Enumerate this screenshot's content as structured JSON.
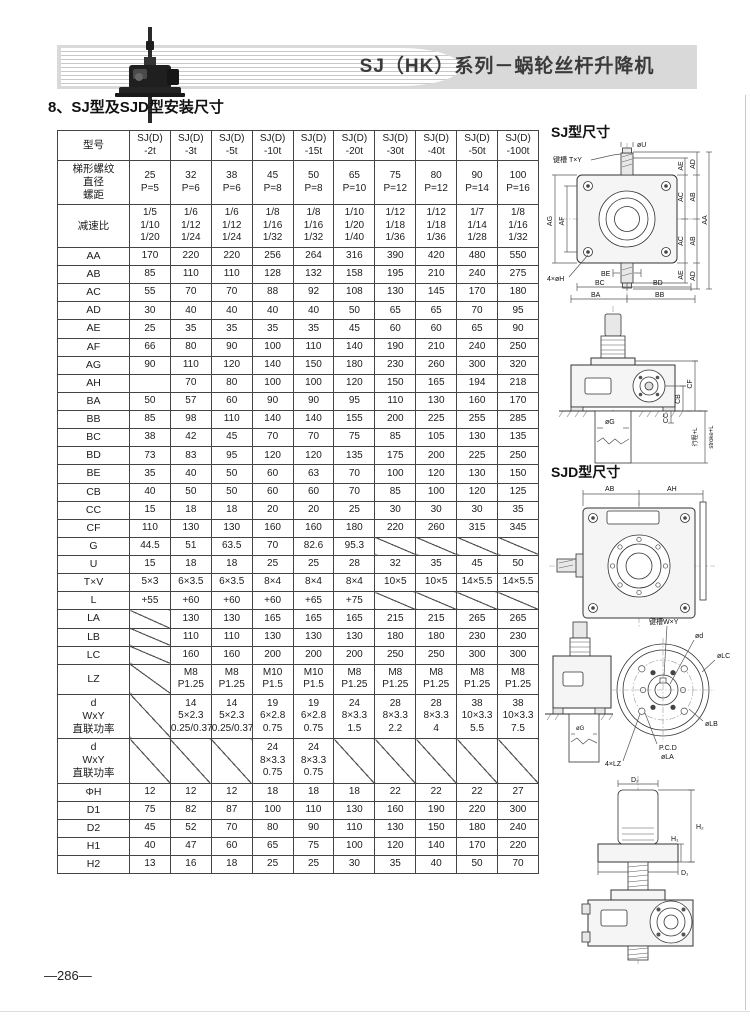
{
  "page": {
    "header_title": "SJ（HK）系列－蜗轮丝杆升降机",
    "section_title": "8、SJ型及SJD型安装尺寸",
    "page_number": "—286—"
  },
  "table": {
    "header": {
      "label": "型号",
      "models": [
        [
          "SJ(D)",
          "-2t"
        ],
        [
          "SJ(D)",
          "-3t"
        ],
        [
          "SJ(D)",
          "-5t"
        ],
        [
          "SJ(D)",
          "-10t"
        ],
        [
          "SJ(D)",
          "-15t"
        ],
        [
          "SJ(D)",
          "-20t"
        ],
        [
          "SJ(D)",
          "-30t"
        ],
        [
          "SJ(D)",
          "-40t"
        ],
        [
          "SJ(D)",
          "-50t"
        ],
        [
          "SJ(D)",
          "-100t"
        ]
      ]
    },
    "rows": [
      {
        "label": [
          "梯形螺纹",
          "直径",
          "螺距"
        ],
        "values": [
          [
            "25",
            "P=5"
          ],
          [
            "32",
            "P=6"
          ],
          [
            "38",
            "P=6"
          ],
          [
            "45",
            "P=8"
          ],
          [
            "50",
            "P=8"
          ],
          [
            "65",
            "P=10"
          ],
          [
            "75",
            "P=12"
          ],
          [
            "80",
            "P=12"
          ],
          [
            "90",
            "P=14"
          ],
          [
            "100",
            "P=16"
          ]
        ]
      },
      {
        "label": "减速比",
        "values": [
          [
            "1/5",
            "1/10",
            "1/20"
          ],
          [
            "1/6",
            "1/12",
            "1/24"
          ],
          [
            "1/6",
            "1/12",
            "1/24"
          ],
          [
            "1/8",
            "1/16",
            "1/32"
          ],
          [
            "1/8",
            "1/16",
            "1/32"
          ],
          [
            "1/10",
            "1/20",
            "1/40"
          ],
          [
            "1/12",
            "1/18",
            "1/36"
          ],
          [
            "1/12",
            "1/18",
            "1/36"
          ],
          [
            "1/7",
            "1/14",
            "1/28"
          ],
          [
            "1/8",
            "1/16",
            "1/32"
          ]
        ]
      },
      {
        "label": "AA",
        "values": [
          "170",
          "220",
          "220",
          "256",
          "264",
          "316",
          "390",
          "420",
          "480",
          "550"
        ]
      },
      {
        "label": "AB",
        "values": [
          "85",
          "110",
          "110",
          "128",
          "132",
          "158",
          "195",
          "210",
          "240",
          "275"
        ]
      },
      {
        "label": "AC",
        "values": [
          "55",
          "70",
          "70",
          "88",
          "92",
          "108",
          "130",
          "145",
          "170",
          "180"
        ]
      },
      {
        "label": "AD",
        "values": [
          "30",
          "40",
          "40",
          "40",
          "40",
          "50",
          "65",
          "65",
          "70",
          "95"
        ]
      },
      {
        "label": "AE",
        "values": [
          "25",
          "35",
          "35",
          "35",
          "35",
          "45",
          "60",
          "60",
          "65",
          "90"
        ]
      },
      {
        "label": "AF",
        "values": [
          "66",
          "80",
          "90",
          "100",
          "110",
          "140",
          "190",
          "210",
          "240",
          "250"
        ]
      },
      {
        "label": "AG",
        "values": [
          "90",
          "110",
          "120",
          "140",
          "150",
          "180",
          "230",
          "260",
          "300",
          "320"
        ]
      },
      {
        "label": "AH",
        "values": [
          "",
          "70",
          "80",
          "100",
          "100",
          "120",
          "150",
          "165",
          "194",
          "218"
        ]
      },
      {
        "label": "BA",
        "values": [
          "50",
          "57",
          "60",
          "90",
          "90",
          "95",
          "110",
          "130",
          "160",
          "170"
        ]
      },
      {
        "label": "BB",
        "values": [
          "85",
          "98",
          "110",
          "140",
          "140",
          "155",
          "200",
          "225",
          "255",
          "285"
        ]
      },
      {
        "label": "BC",
        "values": [
          "38",
          "42",
          "45",
          "70",
          "70",
          "75",
          "85",
          "105",
          "130",
          "135"
        ]
      },
      {
        "label": "BD",
        "values": [
          "73",
          "83",
          "95",
          "120",
          "120",
          "135",
          "175",
          "200",
          "225",
          "250"
        ]
      },
      {
        "label": "BE",
        "values": [
          "35",
          "40",
          "50",
          "60",
          "63",
          "70",
          "100",
          "120",
          "130",
          "150"
        ]
      },
      {
        "label": "CB",
        "values": [
          "40",
          "50",
          "50",
          "60",
          "60",
          "70",
          "85",
          "100",
          "120",
          "125"
        ]
      },
      {
        "label": "CC",
        "values": [
          "15",
          "18",
          "18",
          "20",
          "20",
          "25",
          "30",
          "30",
          "30",
          "35"
        ]
      },
      {
        "label": "CF",
        "values": [
          "110",
          "130",
          "130",
          "160",
          "160",
          "180",
          "220",
          "260",
          "315",
          "345"
        ]
      },
      {
        "label": "G",
        "values": [
          "44.5",
          "51",
          "63.5",
          "70",
          "82.6",
          "95.3",
          "/",
          "/",
          "/",
          "/"
        ]
      },
      {
        "label": "U",
        "values": [
          "15",
          "18",
          "18",
          "25",
          "25",
          "28",
          "32",
          "35",
          "45",
          "50"
        ]
      },
      {
        "label": "T×V",
        "values": [
          "5×3",
          "6×3.5",
          "6×3.5",
          "8×4",
          "8×4",
          "8×4",
          "10×5",
          "10×5",
          "14×5.5",
          "14×5.5"
        ]
      },
      {
        "label": "L",
        "values": [
          "+55",
          "+60",
          "+60",
          "+60",
          "+65",
          "+75",
          "/",
          "/",
          "/",
          "/"
        ]
      },
      {
        "label": "LA",
        "values": [
          "/",
          "130",
          "130",
          "165",
          "165",
          "165",
          "215",
          "215",
          "265",
          "265"
        ]
      },
      {
        "label": "LB",
        "values": [
          "/",
          "110",
          "110",
          "130",
          "130",
          "130",
          "180",
          "180",
          "230",
          "230"
        ]
      },
      {
        "label": "LC",
        "values": [
          "/",
          "160",
          "160",
          "200",
          "200",
          "200",
          "250",
          "250",
          "300",
          "300"
        ]
      },
      {
        "label": "LZ",
        "values": [
          "/",
          [
            "M8",
            "P1.25"
          ],
          [
            "M8",
            "P1.25"
          ],
          [
            "M10",
            "P1.5"
          ],
          [
            "M10",
            "P1.5"
          ],
          [
            "M8",
            "P1.25"
          ],
          [
            "M8",
            "P1.25"
          ],
          [
            "M8",
            "P1.25"
          ],
          [
            "M8",
            "P1.25"
          ],
          [
            "M8",
            "P1.25"
          ]
        ]
      },
      {
        "label": [
          "d",
          "WxY",
          "直联功率"
        ],
        "values": [
          "/",
          [
            "14",
            "5×2.3",
            "0.25/0.37"
          ],
          [
            "14",
            "5×2.3",
            "0.25/0.37"
          ],
          [
            "19",
            "6×2.8",
            "0.75"
          ],
          [
            "19",
            "6×2.8",
            "0.75"
          ],
          [
            "24",
            "8×3.3",
            "1.5"
          ],
          [
            "28",
            "8×3.3",
            "2.2"
          ],
          [
            "28",
            "8×3.3",
            "4"
          ],
          [
            "38",
            "10×3.3",
            "5.5"
          ],
          [
            "38",
            "10×3.3",
            "7.5"
          ]
        ]
      },
      {
        "label": [
          "d",
          "WxY",
          "直联功率"
        ],
        "values": [
          "/",
          "/",
          "/",
          [
            "24",
            "8×3.3",
            "0.75"
          ],
          [
            "24",
            "8×3.3",
            "0.75"
          ],
          "/",
          "/",
          "/",
          "/",
          "/"
        ]
      },
      {
        "label": "ΦH",
        "values": [
          "12",
          "12",
          "12",
          "18",
          "18",
          "18",
          "22",
          "22",
          "22",
          "27"
        ]
      },
      {
        "label": "D1",
        "values": [
          "75",
          "82",
          "87",
          "100",
          "110",
          "130",
          "160",
          "190",
          "220",
          "300"
        ]
      },
      {
        "label": "D2",
        "values": [
          "45",
          "52",
          "70",
          "80",
          "90",
          "110",
          "130",
          "150",
          "180",
          "240"
        ]
      },
      {
        "label": "H1",
        "values": [
          "40",
          "47",
          "60",
          "65",
          "75",
          "100",
          "120",
          "140",
          "170",
          "220"
        ]
      },
      {
        "label": "H2",
        "values": [
          "13",
          "16",
          "18",
          "25",
          "25",
          "30",
          "35",
          "40",
          "50",
          "70"
        ]
      }
    ]
  },
  "drawings": {
    "sj_section_label": "SJ型尺寸",
    "sjd_section_label": "SJD型尺寸",
    "sj_top": {
      "phi_u": "øU",
      "keyway": "键槽 T×Y",
      "ae": "AE",
      "ad": "AD",
      "ac": "AC",
      "ab": "AB",
      "aa": "AA",
      "ag": "AG",
      "af": "AF",
      "holes": "4×øH",
      "be": "BE",
      "bc": "BC",
      "bd": "BD",
      "ba": "BA",
      "bb": "BB"
    },
    "sj_side": {
      "cf": "CF",
      "cb": "CB",
      "cc": "CC",
      "phi_g": "øG",
      "stroke_cn": "行程+L",
      "stroke_en": "stroke+L"
    },
    "sjd_top": {
      "ab": "AB",
      "ah": "AH"
    },
    "sjd_flange": {
      "keyway": "键槽W×Y",
      "phi_d": "ød",
      "phi_lc": "øLC",
      "phi_lb": "øLB",
      "pcd": "P.C.D",
      "phi_la": "øLA",
      "lz": "4×LZ",
      "phi_g": "øG"
    },
    "sj_nut": {
      "d2": "D₂",
      "h2": "H₂",
      "h1": "H₁",
      "d1": "D₁"
    }
  }
}
